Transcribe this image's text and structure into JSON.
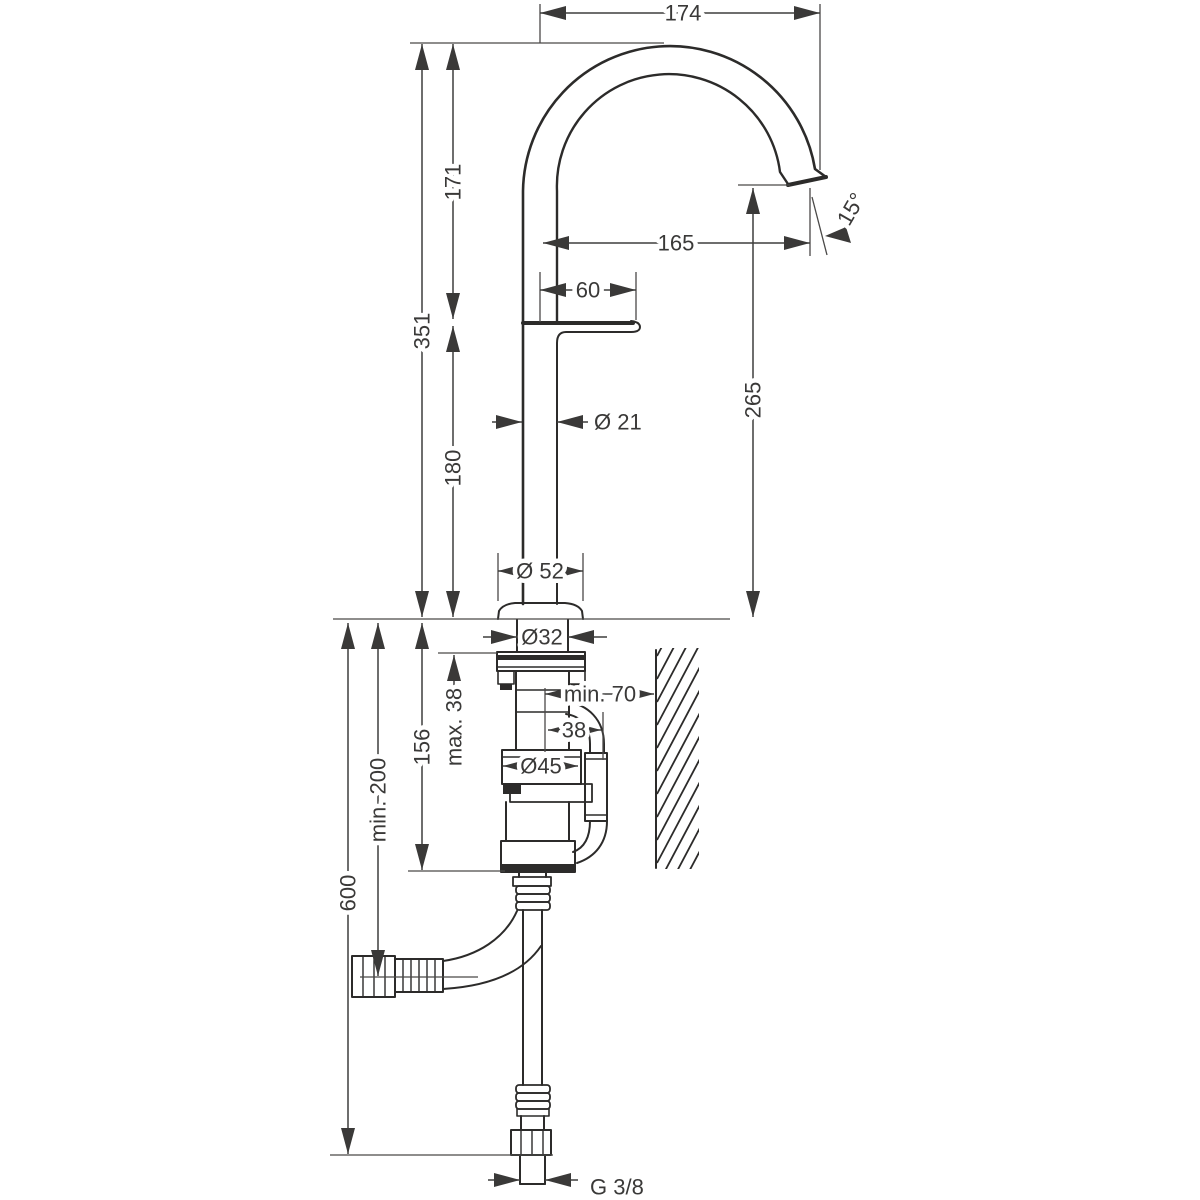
{
  "diagram": {
    "kind": "technical-dimension-drawing",
    "colors": {
      "line": "#2c2b2a",
      "dimension": "#3f3e3d",
      "background": "#ffffff"
    },
    "labels": {
      "spout_width_top": "174",
      "spout_rise": "171",
      "outlet_angle": "15°",
      "spout_reach": "165",
      "handle_length": "60",
      "height_to_top": "351",
      "outlet_height": "265",
      "pipe_diameter": "Ø 21",
      "body_height": "180",
      "base_diameter": "Ø 52",
      "shank_diameter": "Ø32",
      "deck_thickness_max": "max. 38",
      "wall_clearance_min": "min. 70",
      "offset_38": "38",
      "valve_diameter": "Ø45",
      "valve_depth": "156",
      "hose_clearance_min": "min. 200",
      "hose_length": "600",
      "thread_size": "G 3/8"
    }
  }
}
